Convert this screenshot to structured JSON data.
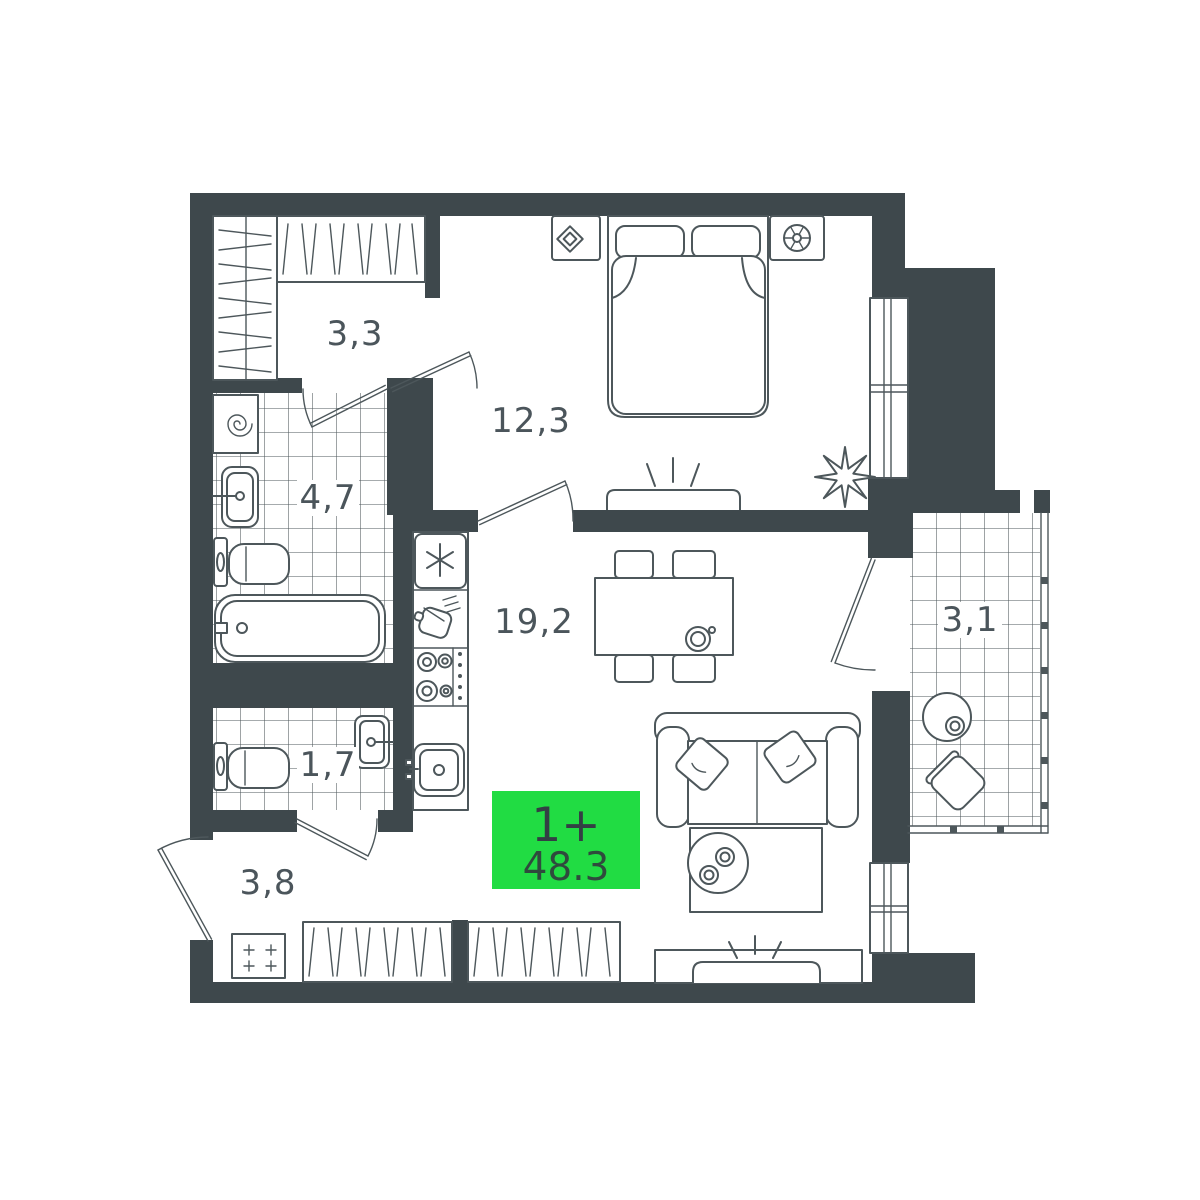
{
  "floor_plan": {
    "badge": {
      "rooms": "1+",
      "area": "48.3",
      "bg_color": "#21DC43",
      "rooms_color": "#333F44",
      "area_color": "#2F4A3D"
    },
    "rooms": [
      {
        "name": "entry-closet",
        "label": "3,3"
      },
      {
        "name": "bedroom",
        "label": "12,3"
      },
      {
        "name": "bathroom",
        "label": "4,7"
      },
      {
        "name": "kitchen-living-room",
        "label": "19,2"
      },
      {
        "name": "wc",
        "label": "1,7"
      },
      {
        "name": "hallway",
        "label": "3,8"
      },
      {
        "name": "balcony",
        "label": "3,1"
      }
    ],
    "colors": {
      "walls": "#3E484C",
      "furniture_lines": "#4D575B",
      "background": "#FFFFFF",
      "room_labels": "#4B555B",
      "accent_green": "#21DC43"
    }
  }
}
